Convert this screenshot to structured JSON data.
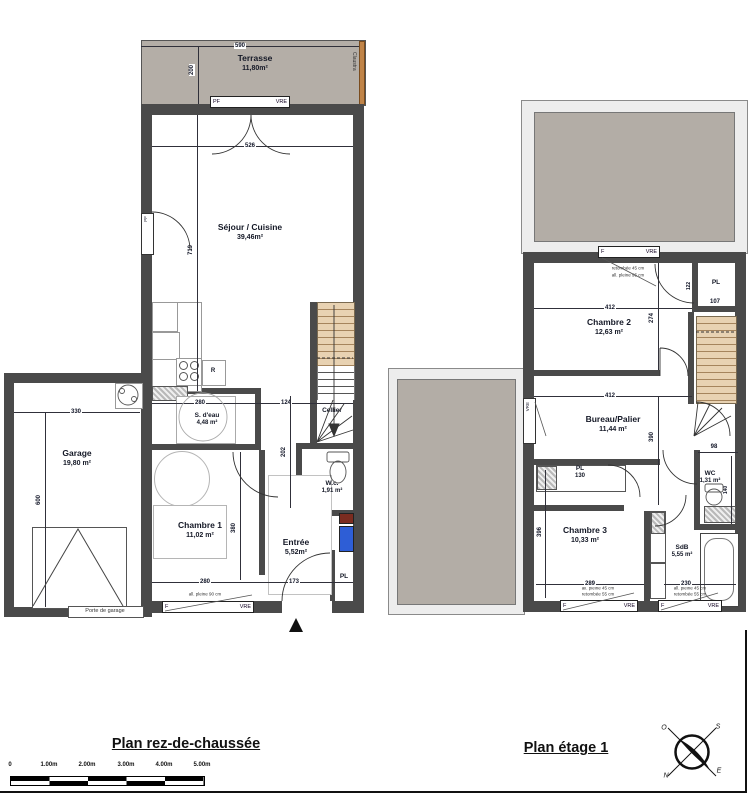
{
  "titles": {
    "ground": "Plan rez-de-chaussée",
    "floor1": "Plan étage 1"
  },
  "ground": {
    "terrasse": {
      "name": "Terrasse",
      "area": "11,80m²"
    },
    "claustra": "Claustra",
    "sejour": {
      "name": "Séjour / Cuisine",
      "area": "39,46m²"
    },
    "garage": {
      "name": "Garage",
      "area": "19,80 m²"
    },
    "garage_door": "Porte de garage",
    "sdeau": {
      "name": "S. d'eau",
      "area": "4,48 m²"
    },
    "cellier": {
      "name": "Cellier"
    },
    "wc": {
      "name": "W.c.",
      "area": "1,91 m²"
    },
    "chambre1": {
      "name": "Chambre 1",
      "area": "11,02 m²"
    },
    "entree": {
      "name": "Entrée",
      "area": "5,52m²"
    },
    "pl": "PL",
    "fridge": "R",
    "dims": {
      "terrasse_w": "590",
      "terrasse_d": "200",
      "sejour_w": "526",
      "sejour_h": "719",
      "garage_w": "330",
      "garage_h": "600",
      "sdeau_w": "280",
      "hall_w": "124",
      "chambre1_w": "280",
      "chambre1_h": "380",
      "entree_w": "173",
      "wc_h": "202"
    },
    "win": {
      "pf": "PF",
      "f": "F",
      "vre": "VRE",
      "allege": "all. pleine 90 cm"
    }
  },
  "floor1": {
    "chambre2": {
      "name": "Chambre 2",
      "area": "12,63 m²"
    },
    "bureau": {
      "name": "Bureau/Palier",
      "area": "11,44 m²"
    },
    "chambre3": {
      "name": "Chambre 3",
      "area": "10,33 m²"
    },
    "sdb": {
      "name": "SdB",
      "area": "5,55 m²"
    },
    "wc": {
      "name": "WC",
      "area": "1,31 m²"
    },
    "pl_top": "PL",
    "pl_mid": "PL",
    "pl_mid_dim": "130",
    "dims": {
      "chambre2_w": "412",
      "chambre2_h": "274",
      "pl_w": "107",
      "pl_h": "122",
      "bureau_w": "412",
      "bureau_h": "390",
      "wc_w": "98",
      "wc_h": "140",
      "chambre3_w": "289",
      "chambre3_h": "396",
      "sdb_w": "230"
    },
    "win": {
      "f": "F",
      "vre": "VRE",
      "note1": "retombée 45 cm",
      "note2": "all. pleine 95 cm",
      "note3": "all. pleine 45 cm",
      "note4": "retombée 55 cm"
    }
  },
  "scalebar": {
    "labels": [
      "0",
      "1.00m",
      "2.00m",
      "3.00m",
      "4.00m",
      "5.00m"
    ]
  },
  "compass": {
    "o": "O",
    "s": "S",
    "n": "N",
    "e": "E"
  }
}
